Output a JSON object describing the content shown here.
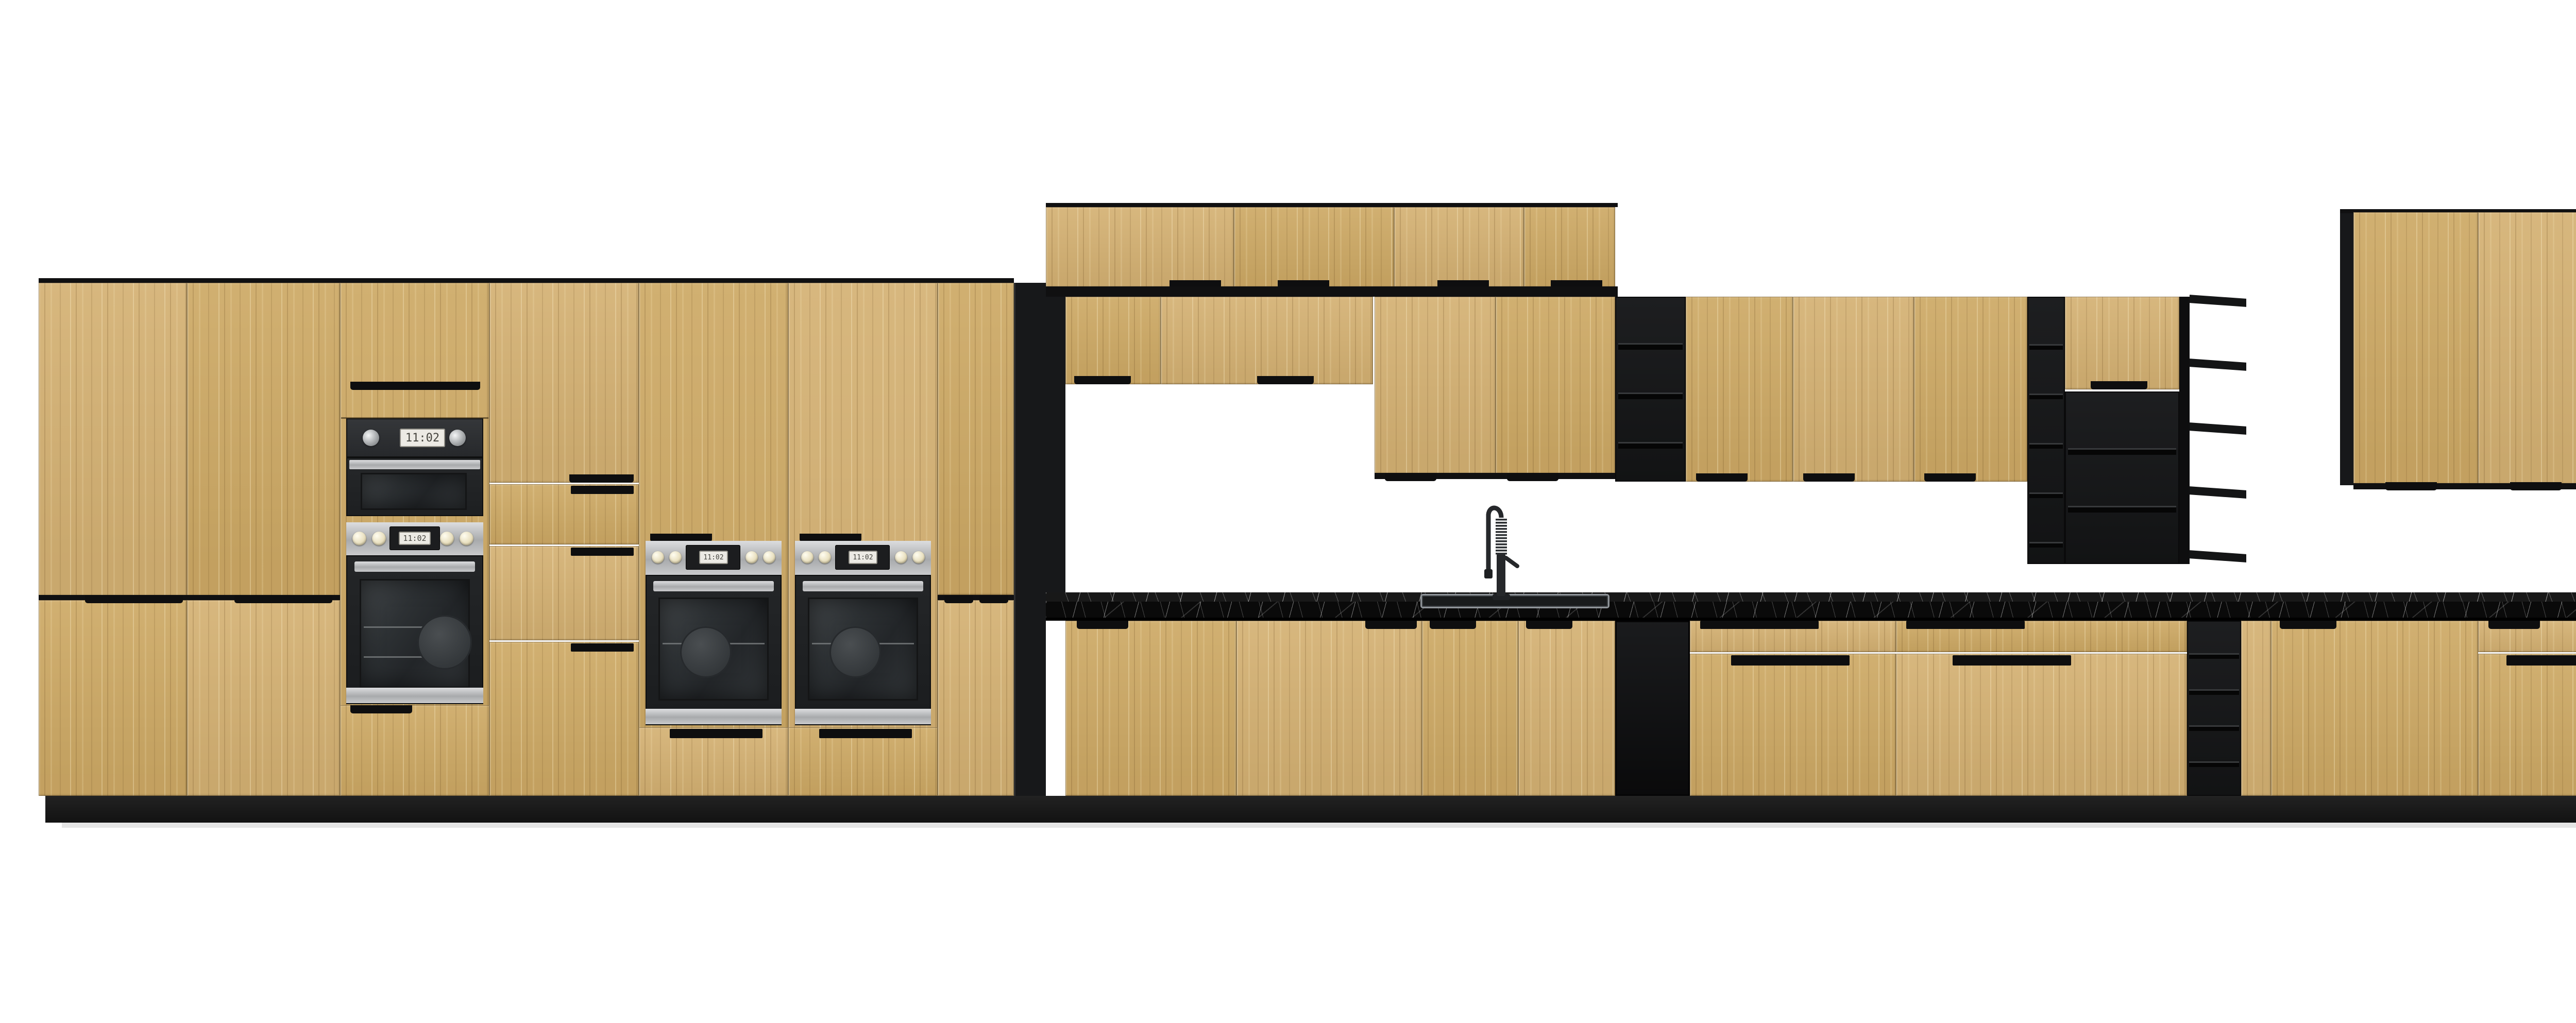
{
  "scene": {
    "type": "kitchen-cabinet-elevation-render",
    "background": "#ffffff"
  },
  "palette": {
    "wood_base": "#c9a566",
    "wood_light": "#d4b173",
    "wood_dark": "#c29d58",
    "frame_black": "#17181a",
    "shelf_black": "#141516",
    "counter_black": "#0a0a0a",
    "counter_vein_white": "#f2f2f2",
    "stainless": "#b8babc",
    "appliance_panel": "#2e3032",
    "oven_glass": "#26282b",
    "knob_cream": "#eee6c9",
    "dishwasher_panel_gray": "#43464a",
    "plinth_black": "#161616"
  },
  "appliances": {
    "compact_oven": {
      "display_time": "11:02"
    },
    "tall_oven": {
      "display_time": "11:02"
    },
    "mid_oven_a": {
      "display_time": "11:02"
    },
    "mid_oven_b": {
      "display_time": "11:02"
    },
    "base_oven": {
      "display_time": "11:02"
    }
  },
  "inventory": {
    "tall_cabinets": 3,
    "oven_towers": 3,
    "wall_door_count_left_block": 9,
    "wall_door_count_right_block": 6,
    "open_shelf_units": 6,
    "base_doors_and_drawers": 18,
    "sink_count": 1,
    "dishwasher_count": 1
  }
}
